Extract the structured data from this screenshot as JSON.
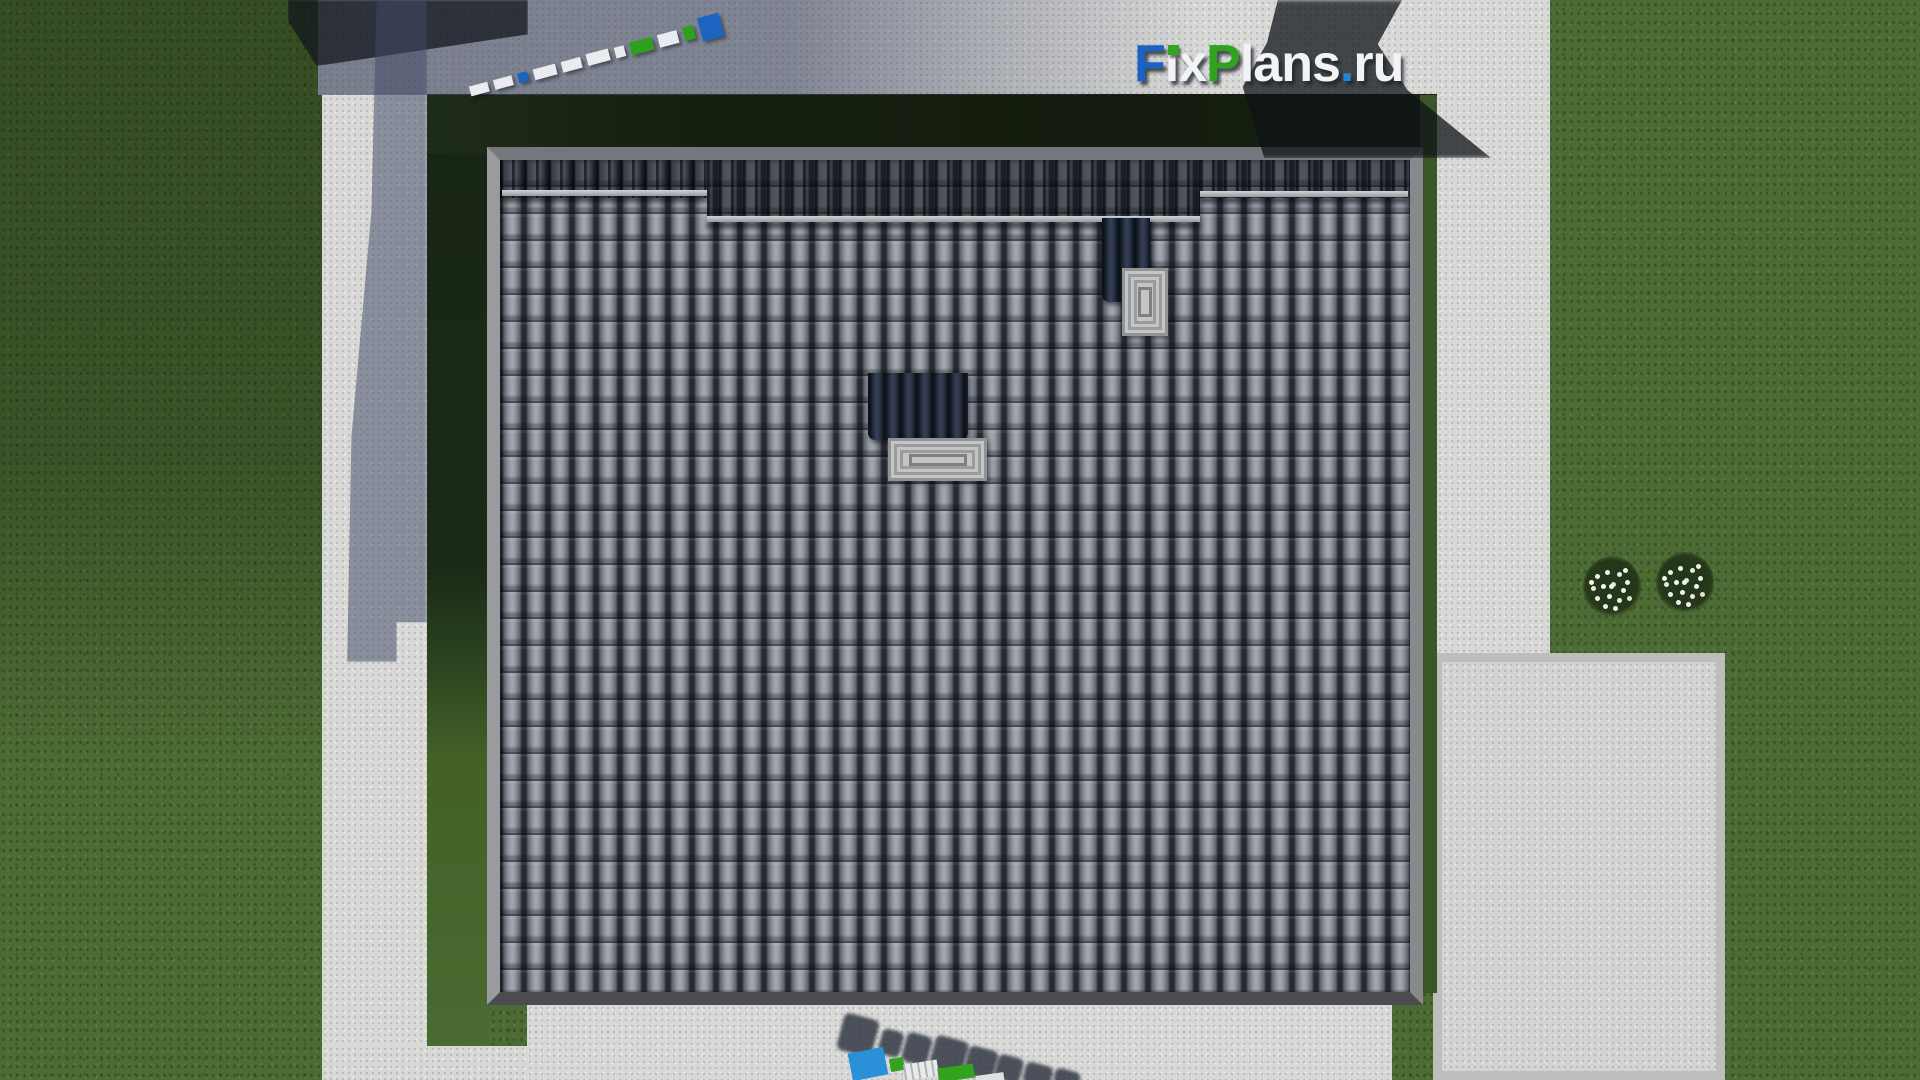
{
  "brand": {
    "logo_text": "FixPlans.ru",
    "letters": [
      {
        "char": "F",
        "color": "#1a63c5"
      },
      {
        "char": "ı",
        "color": "#f2f3f4"
      },
      {
        "char": "x",
        "color": "#f2f3f4"
      },
      {
        "char": "P",
        "color": "#2fa31d"
      },
      {
        "char": "l",
        "color": "#f2f3f4"
      },
      {
        "char": "a",
        "color": "#f2f3f4"
      },
      {
        "char": "n",
        "color": "#f2f3f4"
      },
      {
        "char": "s",
        "color": "#f2f3f4"
      },
      {
        "char": ".",
        "color": "#1d86d2"
      },
      {
        "char": "r",
        "color": "#f2f3f4"
      },
      {
        "char": "u",
        "color": "#f2f3f4"
      }
    ],
    "i_dot_color": "#35a41e"
  },
  "ruler": {
    "segments": [
      {
        "color": "#e9ebee"
      },
      {
        "color": "#e9ebee"
      },
      {
        "color": "#1b64c0"
      },
      {
        "color": "#e9ebee"
      },
      {
        "color": "#e9ebee"
      },
      {
        "color": "#e9ebee"
      },
      {
        "color": "#e9ebee"
      },
      {
        "color": "#2fa01d"
      },
      {
        "color": "#e9ebee"
      },
      {
        "color": "#2fa01d"
      },
      {
        "color": "#1b64c0"
      }
    ]
  },
  "bottom_watermark": {
    "blocks": [
      {
        "color": "#2a90d8"
      },
      {
        "color": "#33a31e"
      },
      {
        "color": "#e8eaec"
      },
      {
        "color": "#33a31e"
      },
      {
        "color": "#dfe2e5"
      }
    ]
  },
  "palette": {
    "grass": "#4d6b34",
    "grass_shadow": "#182516",
    "concrete": "#d8d8d6",
    "concrete_shadow": "#424a63",
    "roof_tile": "#7e818a",
    "roof_tile_gap": "#272a31",
    "fascia": "#88898d",
    "ridge_shadow": "#0d121e",
    "snow_guard": "#c6c7c9",
    "chimney_flue": "#222b3c",
    "chimney_cap": "#c3c4c6",
    "logo_blue": "#1a63c5",
    "logo_green": "#2fa31d",
    "logo_white": "#f2f3f4",
    "logo_dot_blue": "#1d86d2"
  }
}
